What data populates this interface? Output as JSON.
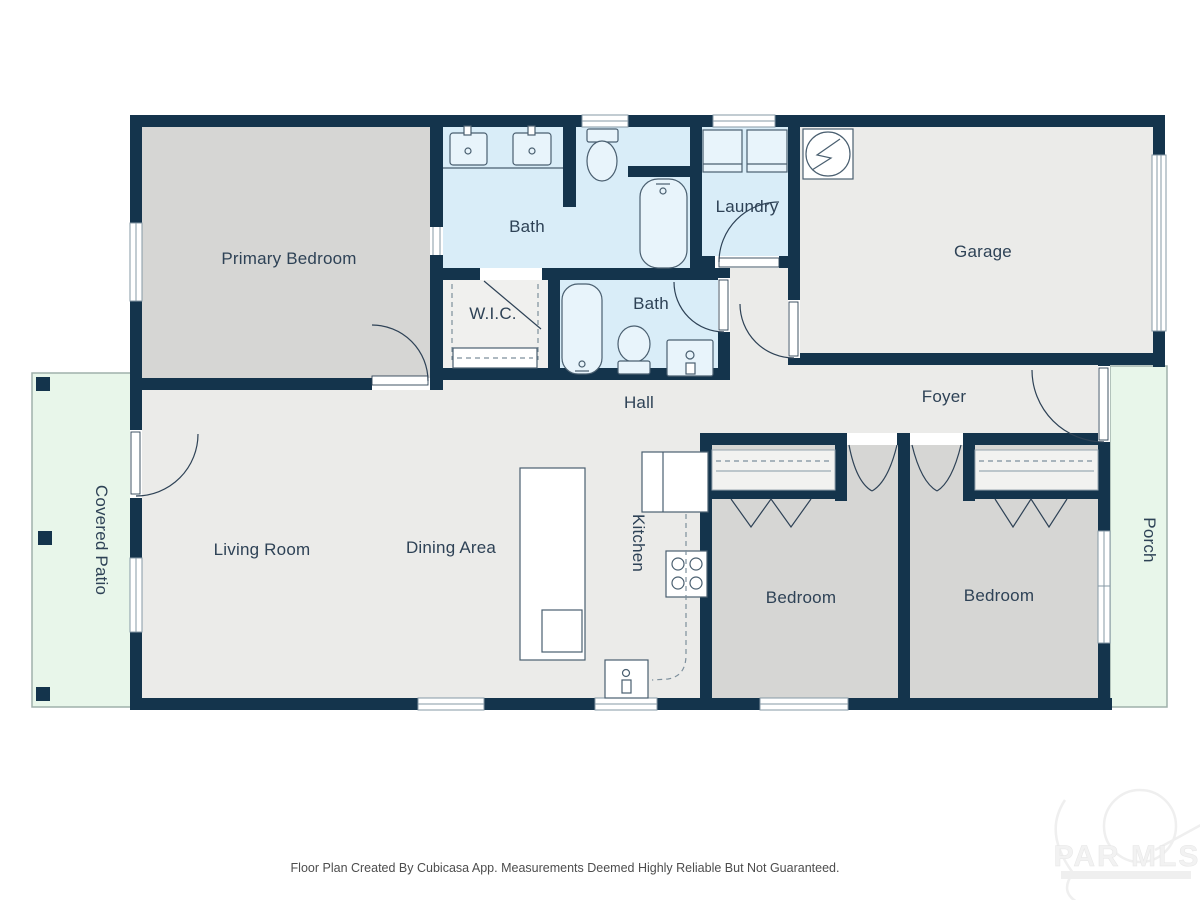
{
  "colors": {
    "wall": "#14344c",
    "floor_gray": "#ebebe9",
    "floor_bedroom": "#d6d6d4",
    "floor_bath": "#d9edf8",
    "floor_outdoor": "#e8f6ea",
    "label_text": "#2e4256",
    "footer_text": "#4d4d4d"
  },
  "rooms": {
    "primary_bedroom": {
      "label": "Primary Bedroom"
    },
    "bath_main": {
      "label": "Bath"
    },
    "laundry": {
      "label": "Laundry"
    },
    "garage": {
      "label": "Garage"
    },
    "wic": {
      "label": "W.I.C."
    },
    "bath_hall": {
      "label": "Bath"
    },
    "hall": {
      "label": "Hall"
    },
    "foyer": {
      "label": "Foyer"
    },
    "covered_patio": {
      "label": "Covered Patio"
    },
    "living_room": {
      "label": "Living Room"
    },
    "dining_area": {
      "label": "Dining Area"
    },
    "kitchen": {
      "label": "Kitchen"
    },
    "bedroom_left": {
      "label": "Bedroom"
    },
    "bedroom_right": {
      "label": "Bedroom"
    },
    "porch": {
      "label": "Porch"
    }
  },
  "footer": {
    "disclaimer": "Floor Plan Created By Cubicasa App. Measurements Deemed Highly Reliable But Not Guaranteed."
  },
  "watermark": {
    "text": "PAR MLS"
  }
}
